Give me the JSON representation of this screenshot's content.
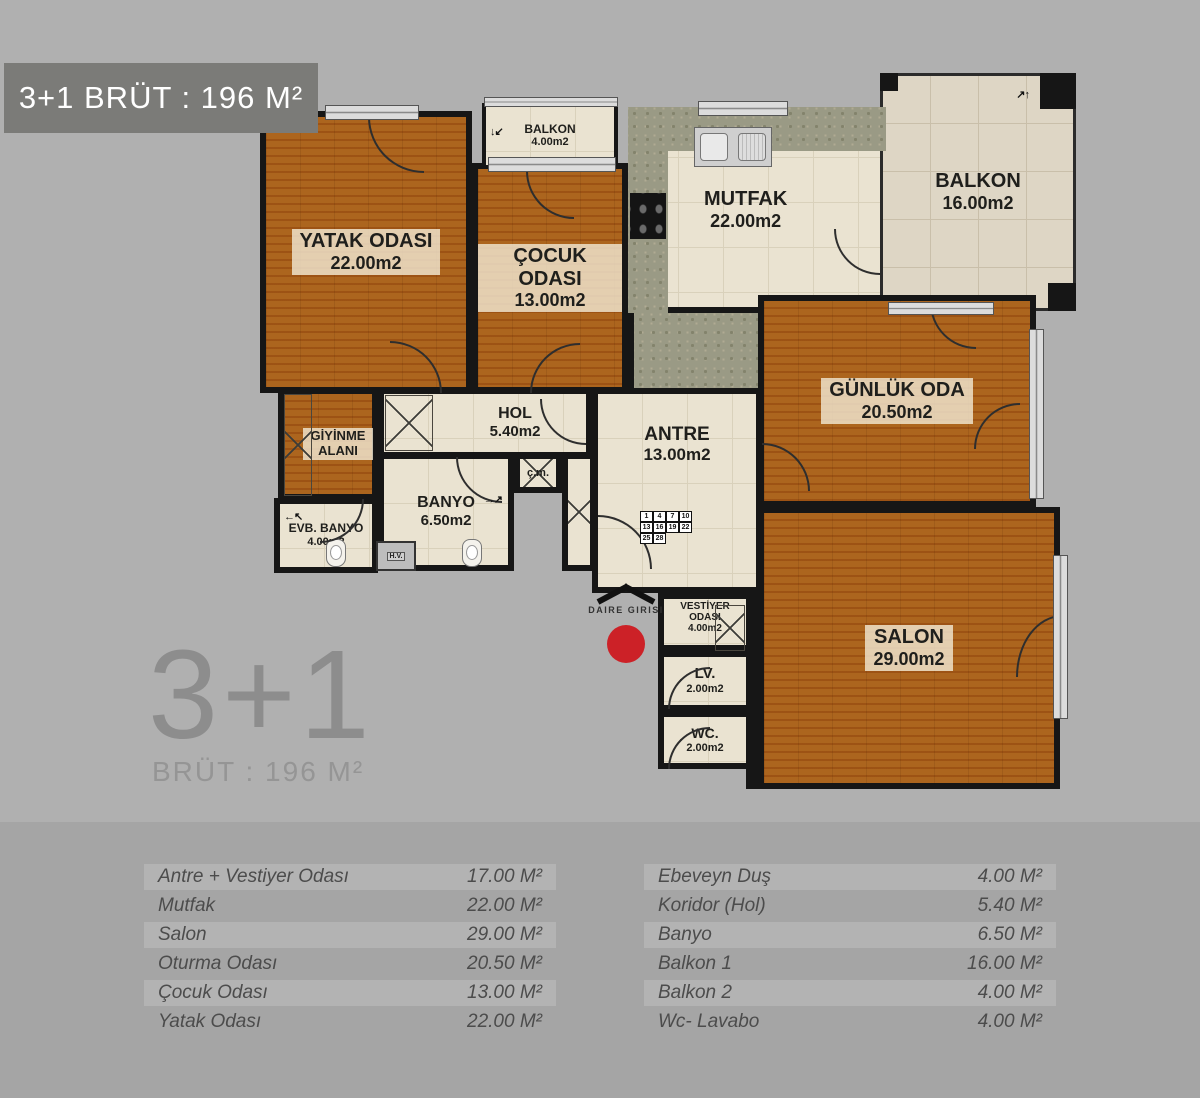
{
  "page": {
    "background": "#b0b0b0",
    "bottom_background": "#a5a5a5",
    "stripe_color": "#b3b3b3"
  },
  "badge": {
    "label": "3+1 BRÜT : 196 M²",
    "background": "#7b7b78",
    "text_color": "#ffffff"
  },
  "summary": {
    "title": "3+1",
    "subtitle": "BRÜT : 196 M²"
  },
  "plan": {
    "wall_color": "#161616",
    "wood_color": "#cf9c52",
    "tile_color": "#eae3d1",
    "balcony_tile_color": "#ded6c5",
    "counter_color": "#9a9a85",
    "entrance": {
      "label": "DAIRE GIRISI",
      "dot_color": "#cc2127"
    },
    "rooms": [
      {
        "name": "YATAK ODASI",
        "area": "22.00m2"
      },
      {
        "name": "ÇOCUK ODASI",
        "area": "13.00m2"
      },
      {
        "name": "BALKON",
        "area": "4.00m2"
      },
      {
        "name": "MUTFAK",
        "area": "22.00m2"
      },
      {
        "name": "BALKON",
        "area": "16.00m2"
      },
      {
        "name": "GÜNLÜK ODA",
        "area": "20.50m2"
      },
      {
        "name": "SALON",
        "area": "29.00m2"
      },
      {
        "name": "GİYİNME ALANI",
        "area": ""
      },
      {
        "name": "HOL",
        "area": "5.40m2"
      },
      {
        "name": "BANYO",
        "area": "6.50m2"
      },
      {
        "name": "EVB. BANYO",
        "area": "4.00m2"
      },
      {
        "name": "ANTRE",
        "area": "13.00m2"
      },
      {
        "name": "VESTİYER ODASI",
        "area": "4.00m2"
      },
      {
        "name": "LV.",
        "area": "2.00m2"
      },
      {
        "name": "WC.",
        "area": "2.00m2"
      }
    ],
    "closet_label": "ç.m.",
    "shaft_label": "H.V.",
    "unit_panel": [
      [
        "1",
        "4",
        "7",
        "10"
      ],
      [
        "13",
        "16",
        "19",
        "22"
      ],
      [
        "25",
        "28"
      ]
    ],
    "icons": {
      "arrows_ne": "↗↑",
      "arrows_sw": "↓↙",
      "arrows_w": "←↖",
      "arrows_e": "→↗"
    }
  },
  "tables": {
    "left": {
      "rows": [
        {
          "label": "Antre + Vestiyer Odası",
          "value": "17.00 M²"
        },
        {
          "label": "Mutfak",
          "value": "22.00 M²"
        },
        {
          "label": "Salon",
          "value": "29.00 M²"
        },
        {
          "label": "Oturma Odası",
          "value": "20.50 M²"
        },
        {
          "label": "Çocuk Odası",
          "value": "13.00 M²"
        },
        {
          "label": "Yatak Odası",
          "value": "22.00 M²"
        }
      ]
    },
    "right": {
      "rows": [
        {
          "label": "Ebeveyn Duş",
          "value": "4.00 M²"
        },
        {
          "label": "Koridor (Hol)",
          "value": "5.40 M²"
        },
        {
          "label": "Banyo",
          "value": "6.50 M²"
        },
        {
          "label": "Balkon 1",
          "value": "16.00 M²"
        },
        {
          "label": "Balkon 2",
          "value": "4.00 M²"
        },
        {
          "label": "Wc- Lavabo",
          "value": "4.00 M²"
        }
      ]
    }
  }
}
